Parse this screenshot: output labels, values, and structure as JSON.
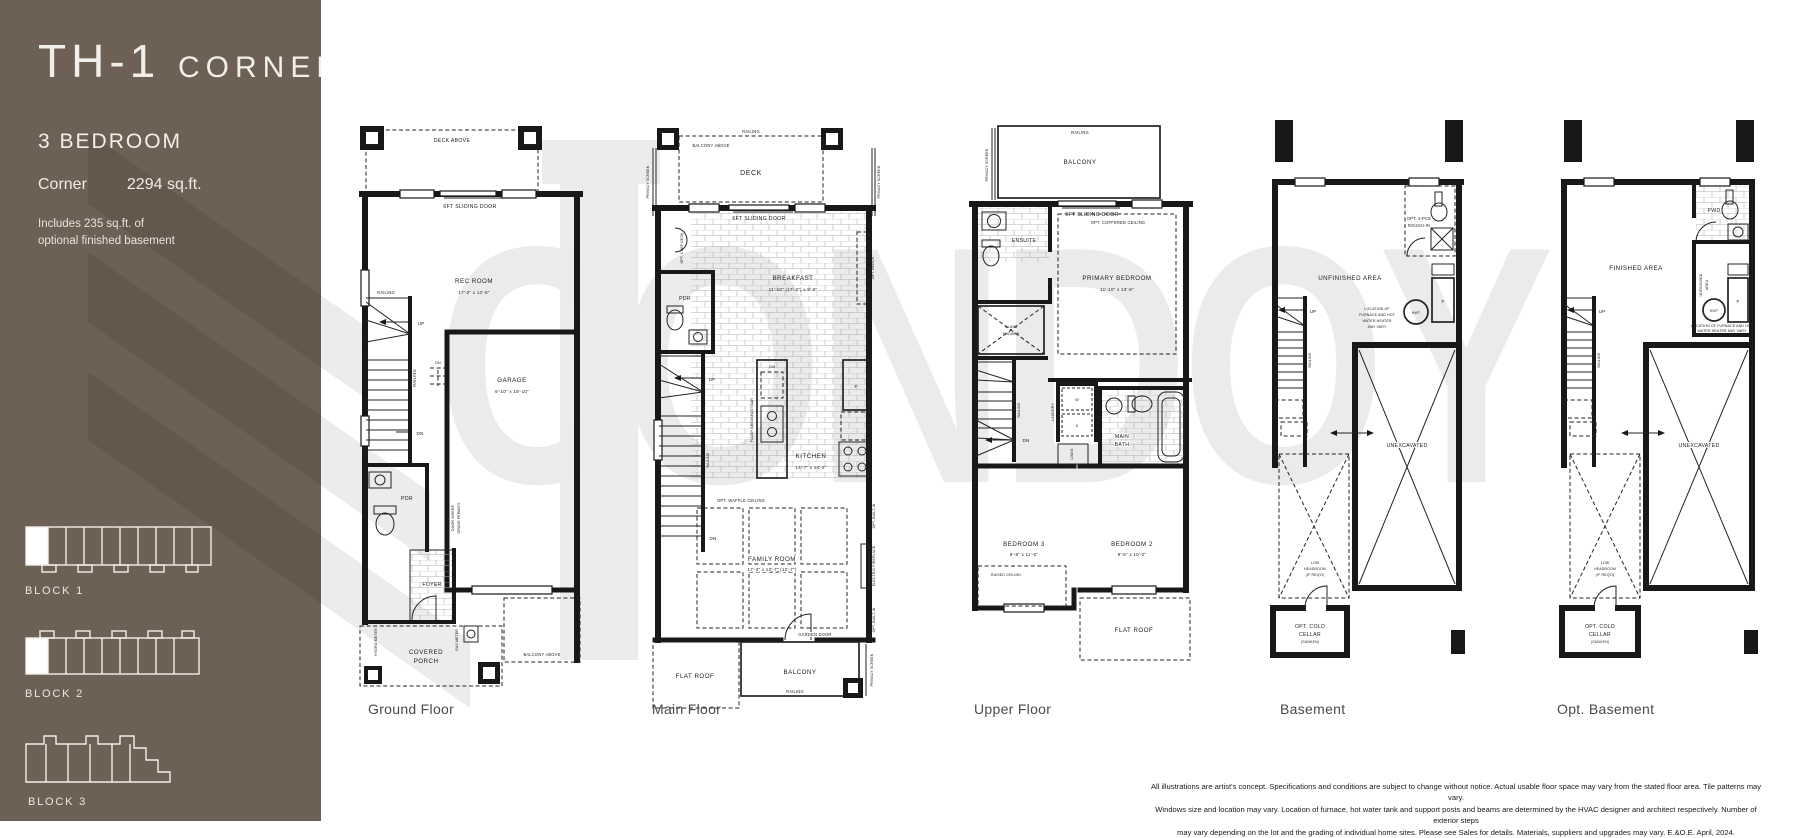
{
  "sidebar": {
    "title_main": "TH-1",
    "title_sub": "CORNER",
    "bedrooms": "3 BEDROOM",
    "type_label": "Corner",
    "area": "2294 sq.ft.",
    "note_line1": "Includes 235 sq.ft. of",
    "note_line2": "optional finished basement",
    "bg_color": "#6d6055",
    "blocks": [
      {
        "label": "BLOCK 1"
      },
      {
        "label": "BLOCK 2"
      },
      {
        "label": "BLOCK 3"
      }
    ]
  },
  "watermark": {
    "text": "CONDOY"
  },
  "captions": {
    "ground": "Ground Floor",
    "main": "Main Floor",
    "upper": "Upper Floor",
    "basement": "Basement",
    "opt_basement": "Opt. Basement"
  },
  "plans": {
    "ground": {
      "deck_above": "DECK ABOVE",
      "sliding_door": "6FT SLIDING DOOR",
      "rec_room": "REC ROOM",
      "rec_room_dim": "17'-2\" x 12'-6\"",
      "railing_h": "RAILING",
      "railing_v": "RAILING",
      "up": "UP",
      "dn": "DN",
      "dn_steps": "DN",
      "garage": "GARAGE",
      "garage_dim": "9'-10\" x 19'-10\"",
      "pdr": "PDR",
      "door_grade1": "DOOR WHERE",
      "door_grade2": "GRADE PERMITS",
      "foyer": "FOYER",
      "porch1": "COVERED",
      "porch2": "PORCH",
      "hydro": "HYDRO METER",
      "gas": "GAS METER",
      "balcony_above": "BALCONY ABOVE"
    },
    "main": {
      "privacy_left": "PRIVACY SCREEN",
      "privacy_right": "PRIVACY SCREEN",
      "railing_top": "RAILING",
      "balcony_above": "BALCONY ABOVE",
      "deck": "DECK",
      "sliding_door": "6FT SLIDING DOOR",
      "chef_desk": "OPT. CHEF DESK",
      "pdr": "PDR",
      "breakfast": "BREAKFAST",
      "breakfast_dim": "11'-10\" (17'-2\") x 9'-0\"",
      "opt_bench": "OPT. BENCH",
      "up": "UP",
      "dn": "DN",
      "railing_stairs": "RAILING",
      "breakfast_bar": "FLUSH BREAKFAST BAR",
      "dw": "DW",
      "fridge": "F",
      "kitchen": "KITCHEN",
      "kitchen_dim": "14'-7\" x 14'-2\"",
      "waffle": "OPT. WAFFLE CEILING",
      "family": "FAMILY ROOM",
      "family_dim": "17'-2\" x 13'-7\" (12'-7\")",
      "builtin_top": "OPT. BUILT-IN",
      "fireplace": "ELECTRIC FIREPLACE",
      "builtin_bottom": "OPT. BUILT-IN",
      "garden_door": "GARDEN DOOR",
      "balcony": "BALCONY",
      "railing_balcony": "RAILING",
      "flat_roof": "FLAT ROOF",
      "privacy_balcony": "PRIVACY SCREEN"
    },
    "upper": {
      "railing_top": "RAILING",
      "balcony": "BALCONY",
      "privacy": "PRIVACY SCREEN",
      "sliding_door": "5FT SLIDING DOOR",
      "coffered": "OPT. COFFERED CEILING",
      "primary": "PRIMARY BEDROOM",
      "primary_dim": "11'-10\" x 13'-6\"",
      "ensuite": "ENSUITE",
      "glass1": "GLASS",
      "glass2": "SHOWER",
      "railing_stairs": "RAILING",
      "dn": "DN",
      "laundry": "LAUNDRY",
      "w": "W",
      "d": "D",
      "linen": "LINEN",
      "main_bath1": "MAIN",
      "main_bath2": "BATH",
      "bed3": "BEDROOM 3",
      "bed3_dim": "8'-5\" x 11'-5\"",
      "raised": "RAISED CEILING",
      "bed2": "BEDROOM 2",
      "bed2_dim": "8'-5\" x 10'-2\"",
      "flat_roof": "FLAT ROOF"
    },
    "basement": {
      "unfinished": "UNFINISHED AREA",
      "roughin1": "OPT. 3-PCE",
      "roughin2": "ROUGH-IN",
      "hwt": "HWT",
      "f": "F",
      "note1": "LOCATION OF",
      "note2": "FURNACE AND HOT",
      "note3": "WATER HEATER",
      "note4": "MAY VARY",
      "up": "UP",
      "railing": "RAILING",
      "unexcavated": "UNEXCAVATED",
      "low1": "LOW",
      "low2": "HEADROOM",
      "low3": "(IF REQ'D)",
      "cellar1": "OPT. COLD",
      "cellar2": "CELLAR",
      "cellar3": "(SUNKEN)"
    },
    "opt_basement": {
      "finished": "FINISHED AREA",
      "pwd": "PWD",
      "unf1": "UNFINISHED",
      "unf2": "AREA",
      "hwt": "HWT",
      "f": "F",
      "note1": "LOCATION OF FURNACE AND HOT",
      "note2": "WATER HEATER MAY VARY",
      "up": "UP",
      "railing": "RAILING",
      "unexcavated": "UNEXCAVATED",
      "low1": "LOW",
      "low2": "HEADROOM",
      "low3": "(IF REQ'D)",
      "cellar1": "OPT. COLD",
      "cellar2": "CELLAR",
      "cellar3": "(SUNKEN)"
    }
  },
  "disclaimer": {
    "line1": "All illustrations are artist's concept. Specifications and conditions are subject to change without notice. Actual usable floor space may vary from the stated floor area. Tile patterns may vary.",
    "line2": "Windows size and location may vary. Location of furnace, hot water tank and support posts and beams are determined by the HVAC designer and architect respectively. Number of exterior steps",
    "line3": "may vary depending on the lot and the grading of individual home sites. Please see Sales for details. Materials, suppliers and upgrades may vary. E.&O.E. April, 2024."
  }
}
